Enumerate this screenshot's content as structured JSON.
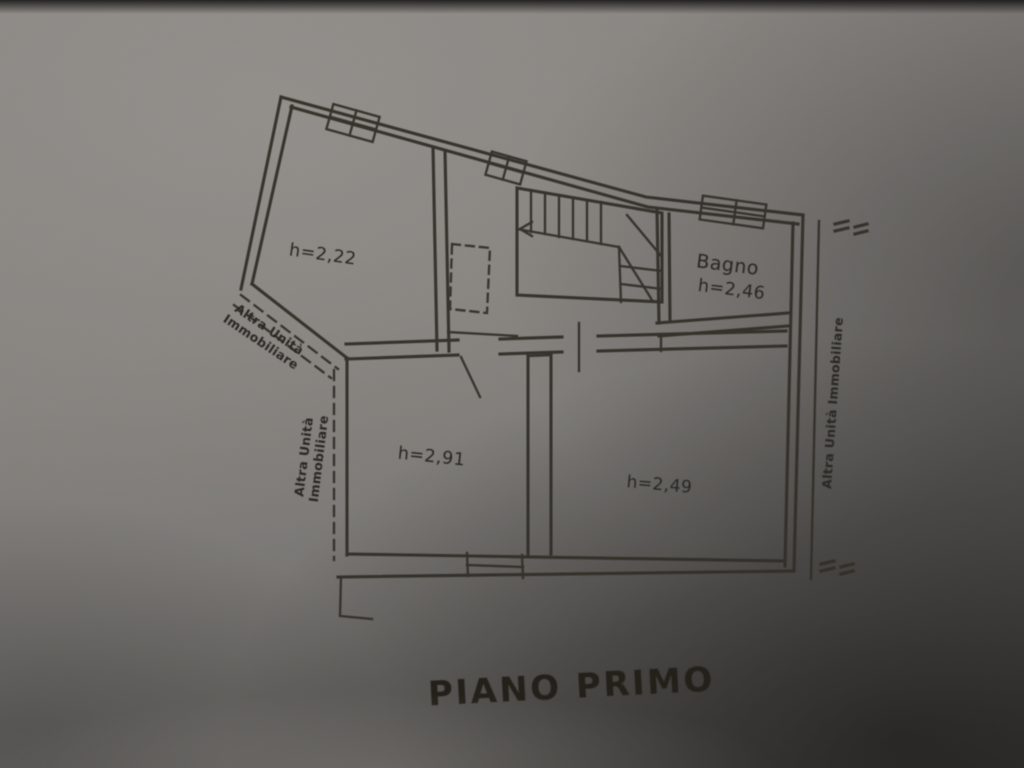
{
  "document": {
    "title_label": "PIANO PRIMO"
  },
  "plan": {
    "rooms": [
      {
        "height_label": "h=2,22"
      },
      {
        "name_label": "Bagno",
        "height_label": "h=2,46"
      },
      {
        "height_label": "h=2,91"
      },
      {
        "height_label": "h=2,49"
      }
    ],
    "adjacent_unit_labels": {
      "diagonal": {
        "line1": "Altra Unità",
        "line2": "Immobiliare"
      },
      "left": {
        "line1": "Altra Unità",
        "line2": "Immobiliare"
      },
      "right": {
        "text": "Altra Unità Immobiliare"
      }
    },
    "colors": {
      "ink": "#34312c",
      "paper_light": "#8f8c88",
      "paper_dark": "#3a3836"
    }
  }
}
